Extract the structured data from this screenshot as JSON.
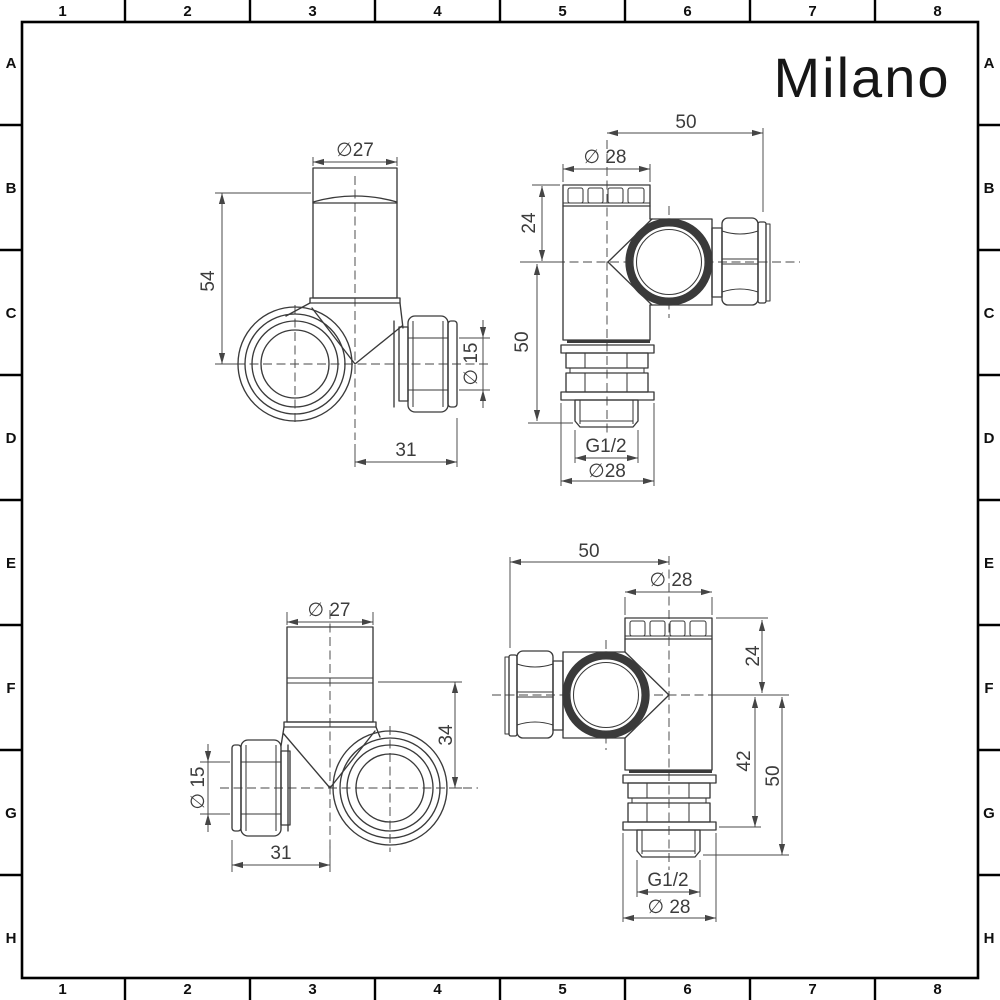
{
  "logo": {
    "text": "Milano"
  },
  "frame": {
    "columns": [
      "1",
      "2",
      "3",
      "4",
      "5",
      "6",
      "7",
      "8"
    ],
    "rows": [
      "A",
      "B",
      "C",
      "D",
      "E",
      "F",
      "G",
      "H"
    ]
  },
  "views": {
    "top_left": {
      "dims": {
        "head_diameter": "∅27",
        "height": "54",
        "pipe_diameter": "∅ 15",
        "outlet_length": "31"
      }
    },
    "top_right": {
      "dims": {
        "overall_depth": "50",
        "head_diameter": "∅ 28",
        "head_height": "24",
        "body_height": "50",
        "thread": "G1/2",
        "base_diameter": "∅28"
      }
    },
    "bottom_left": {
      "dims": {
        "head_diameter": "∅ 27",
        "body_height": "34",
        "pipe_diameter": "∅ 15",
        "outlet_length": "31"
      }
    },
    "bottom_right": {
      "dims": {
        "overall_depth": "50",
        "head_diameter": "∅ 28",
        "head_height": "24",
        "valve_height": "42",
        "body_height": "50",
        "thread": "G1/2",
        "base_diameter": "∅ 28"
      }
    }
  }
}
